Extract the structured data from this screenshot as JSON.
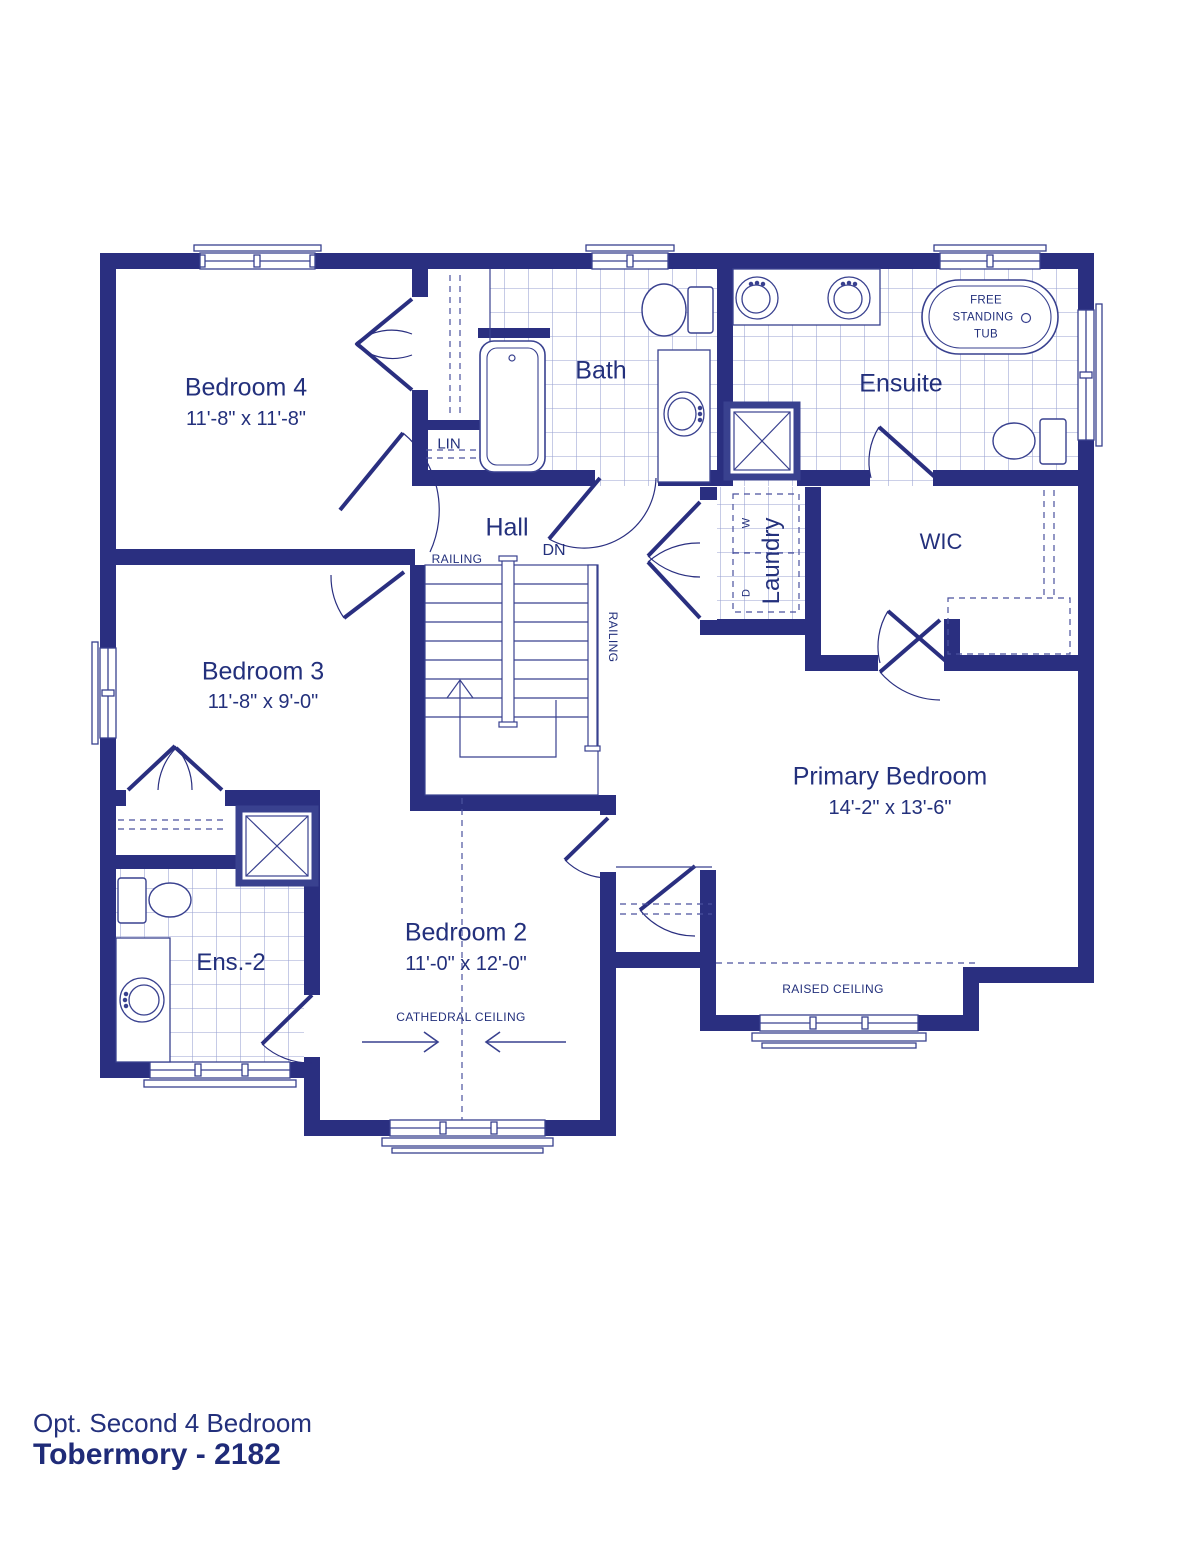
{
  "rooms": {
    "bedroom4": {
      "name": "Bedroom 4",
      "dims": "11'-8\" x 11'-8\""
    },
    "bedroom3": {
      "name": "Bedroom 3",
      "dims": "11'-8\" x 9'-0\""
    },
    "bedroom2": {
      "name": "Bedroom 2",
      "dims": "11'-0\" x 12'-0\""
    },
    "primary_bedroom": {
      "name": "Primary Bedroom",
      "dims": "14'-2\" x 13'-6\""
    },
    "bath": {
      "name": "Bath"
    },
    "ensuite": {
      "name": "Ensuite"
    },
    "ensuite2": {
      "name": "Ens.-2"
    },
    "wic": {
      "name": "WIC"
    },
    "hall": {
      "name": "Hall"
    },
    "linen_closet": {
      "name": "LIN"
    },
    "laundry": {
      "name": "Laundry",
      "washer_label": "W",
      "dryer_label": "D"
    }
  },
  "fixtures": {
    "free_standing_tub": {
      "line1": "FREE",
      "line2": "STANDING",
      "line3": "TUB"
    }
  },
  "stairs": {
    "down_label": "DN",
    "railing_top_label": "RAILING",
    "railing_side_label": "RAILING"
  },
  "ceilings": {
    "cathedral": "CATHEDRAL CEILING",
    "raised": "RAISED CEILING"
  },
  "footer": {
    "option": "Opt. Second 4 Bedroom",
    "model": "Tobermory - 2182"
  },
  "colors": {
    "wall": "#2a2f80",
    "line": "#39418f",
    "tile_line": "#98a0d0",
    "text": "#23307c",
    "background": "#ffffff"
  }
}
